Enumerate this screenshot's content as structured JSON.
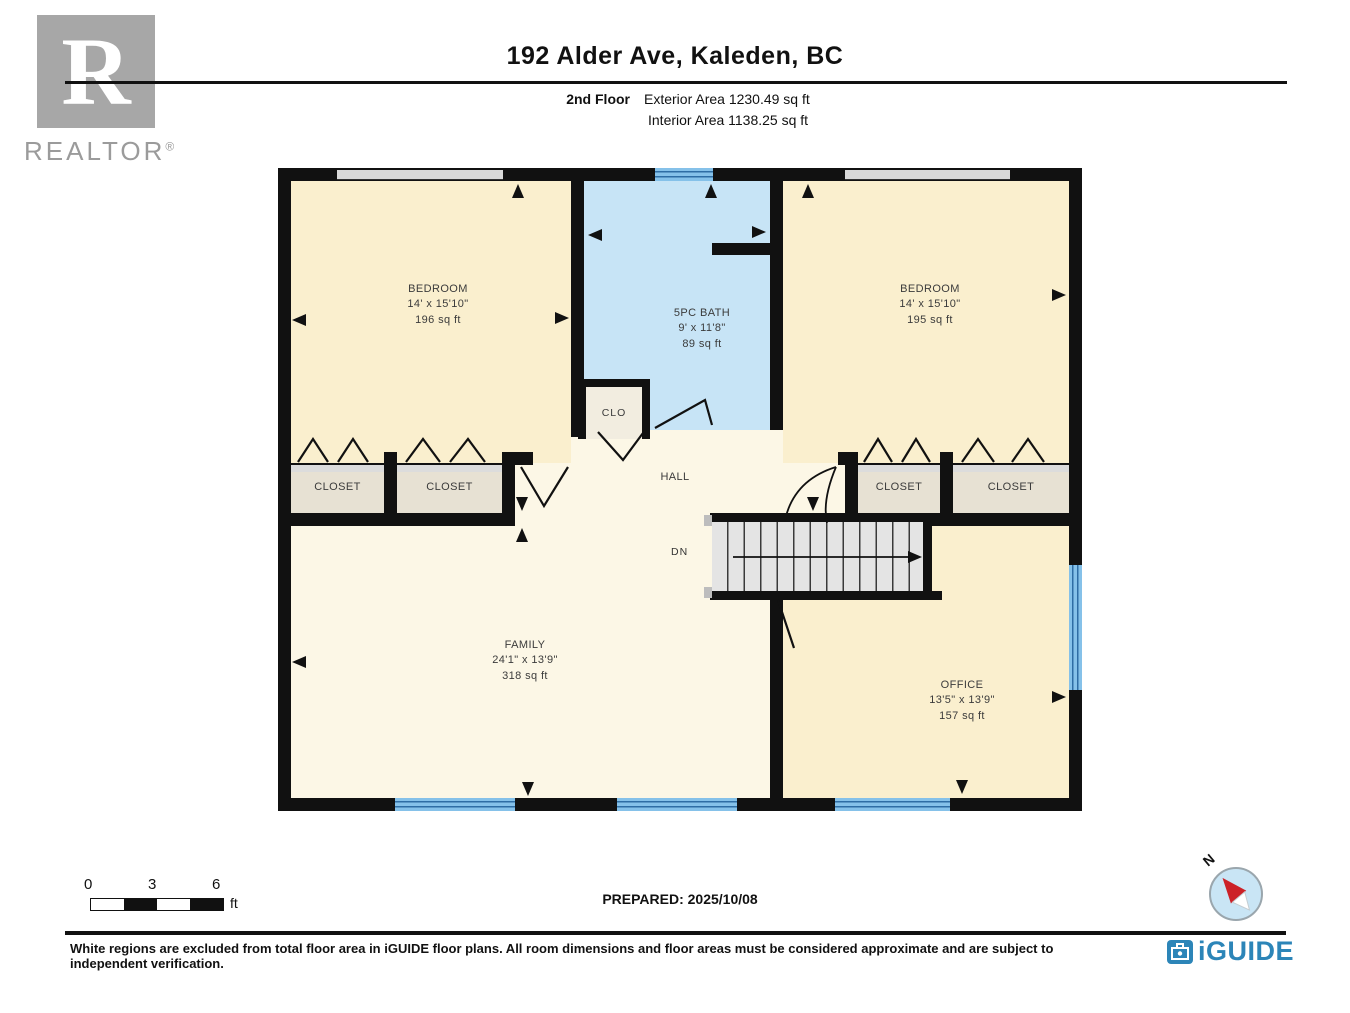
{
  "header": {
    "title": "192 Alder Ave, Kaleden, BC",
    "floor_label": "2nd Floor",
    "exterior_area": "Exterior Area 1230.49 sq ft",
    "interior_area": "Interior Area 1138.25 sq ft",
    "realtor_logo_letter": "R",
    "realtor_logo_text": "REALTOR",
    "realtor_logo_reg": "®"
  },
  "rooms": {
    "bedroom_left": {
      "name": "BEDROOM",
      "dims": "14' x 15'10\"",
      "area": "196 sq ft"
    },
    "bath": {
      "name": "5PC BATH",
      "dims": "9' x 11'8\"",
      "area": "89 sq ft"
    },
    "bedroom_right": {
      "name": "BEDROOM",
      "dims": "14' x 15'10\"",
      "area": "195 sq ft"
    },
    "clo": {
      "name": "CLO"
    },
    "hall": {
      "name": "HALL"
    },
    "closet": {
      "name": "CLOSET"
    },
    "family": {
      "name": "FAMILY",
      "dims": "24'1\" x 13'9\"",
      "area": "318 sq ft"
    },
    "office": {
      "name": "OFFICE",
      "dims": "13'5\" x 13'9\"",
      "area": "157 sq ft"
    }
  },
  "stairs": {
    "label": "DN"
  },
  "scale_bar": {
    "tick0": "0",
    "tick1": "3",
    "tick2": "6",
    "unit": "ft"
  },
  "compass": {
    "label": "N"
  },
  "footer": {
    "prepared": "PREPARED: 2025/10/08",
    "disclaimer": "White regions are excluded from total floor area in iGUIDE floor plans. All room dimensions and floor areas must be considered approximate and are subject to independent verification.",
    "brand": "iGUIDE"
  },
  "colors": {
    "wall": "#111111",
    "bedroom_fill": "#FAEFCE",
    "hall_family_fill": "#FCF7E6",
    "bath_fill": "#C7E4F6",
    "closet_fill": "#E7E1D3",
    "window_blue": "#85C1E9",
    "window_line": "#2E6DA4",
    "stairs_fill": "#E4E4E4",
    "brand_blue": "#2C85B8",
    "logo_gray": "#A7A7A7",
    "compass_red": "#CC2127"
  }
}
